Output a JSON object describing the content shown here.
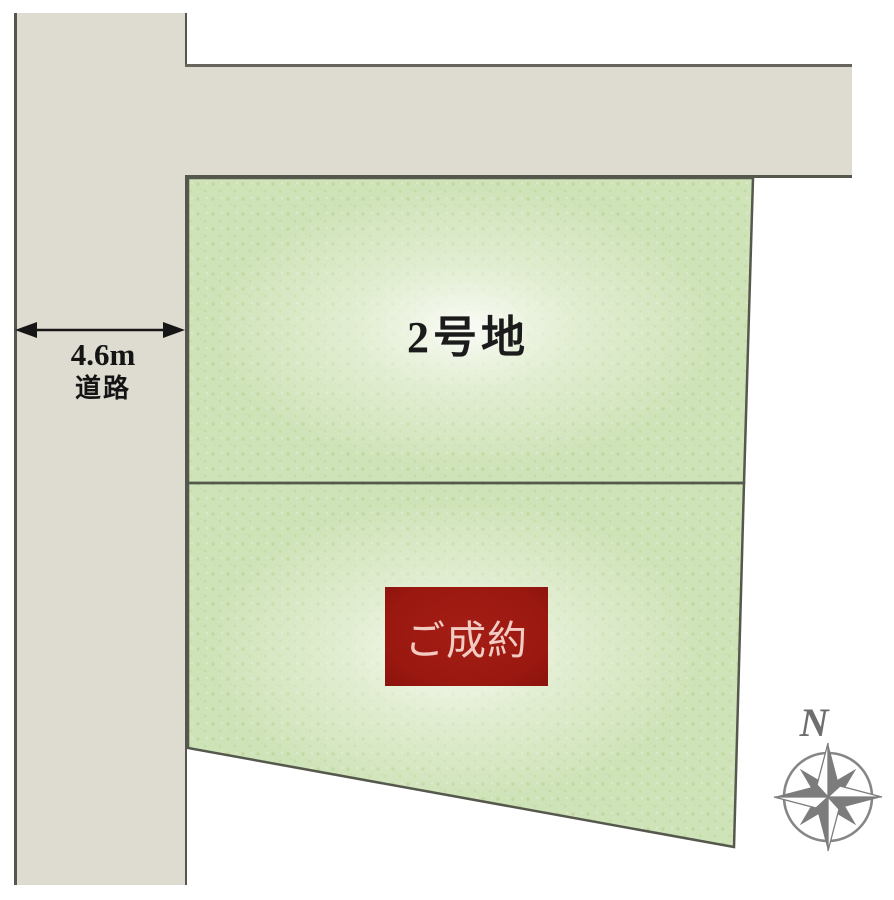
{
  "canvas": {
    "width_px": 894,
    "height_px": 900
  },
  "road": {
    "width_label": "4.6m",
    "type_label": "道路"
  },
  "lots": {
    "lot2": {
      "label": "2号地"
    },
    "lot1": {
      "sold_badge": "ご成約"
    }
  },
  "compass": {
    "north_label": "N"
  },
  "colors": {
    "road_fill": "#dedcd1",
    "boundary_line": "#55584c",
    "lot_fill": "#cfe3b9",
    "lot_highlight": "#f2f6e8",
    "lot_speckle": "#c1d79f",
    "sold_badge_bg": "#9a1810",
    "sold_badge_text": "#f2cbc3",
    "compass_gray": "#7c7c7c",
    "label_text": "#1b1b1b"
  }
}
